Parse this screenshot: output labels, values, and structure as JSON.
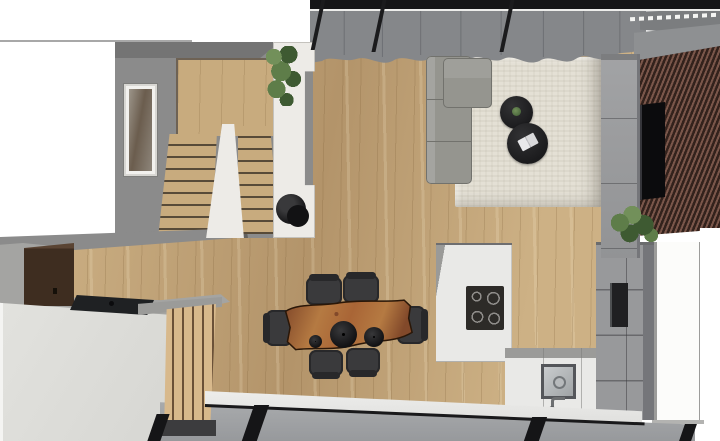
{
  "scene": {
    "view": "top-down 3D architectural render of an open-plan ground floor",
    "areas": {
      "stair_hall": [
        "u-shaped-staircase",
        "wall-art",
        "white-partition-wall",
        "hanging-plant",
        "black-round-stool"
      ],
      "living": [
        "corner-sofa",
        "area-rug",
        "two-round-coffee-tables",
        "small-plant-decor",
        "open-book",
        "tv-screen",
        "slat-accent-wall",
        "tv-cabinet-column",
        "potted-plant",
        "curtain-glazed-wall"
      ],
      "dining": [
        "live-edge-wood-table",
        "six-black-chairs",
        "three-round-pendants"
      ],
      "kitchen": [
        "island-with-induction-cooktop",
        "sink-counter-with-faucet",
        "tall-appliance-wall-with-oven",
        "white-door"
      ],
      "desk_nook": [
        "dark-brown-wall-cabinet",
        "gray-desk-top",
        "laptop",
        "white-counter-block",
        "wood-slat-screen"
      ],
      "facade": [
        "glazed-sliding-wall-bottom",
        "glazed-roof-edge-top",
        "gray-beam"
      ]
    }
  },
  "palette": {
    "background": "#ffffff",
    "wall_gray": "#8b8b8b",
    "wall_gray_dark": "#747474",
    "floor_wood": "#cdb185",
    "floor_wood_streak": "#b3946a",
    "stair_wood": "#c8ab7e",
    "stair_nosing": "#574a38",
    "white_wall": "#edebe7",
    "rug": "#e4e0d5",
    "sofa": "#95958f",
    "sofa_dark": "#72726d",
    "coffee_table_black": "#1b1b1d",
    "chair_black": "#3a3a3c",
    "chair_black_dark": "#28282a",
    "dining_wood": "#a96536",
    "dining_wood_light": "#b57a42",
    "dining_wood_dark": "#82492a",
    "dining_edge": "#2a1708",
    "slat_brown": "#7a564a",
    "slat_brown_dark": "#33221c",
    "tv_black": "#0b0b0d",
    "cabinet_gray": "#98999b",
    "cabinet_gray_dark": "#75767a",
    "island_white": "#e9e9e7",
    "island_side": "#9a9a98",
    "cooktop_black": "#2d2b28",
    "cooktop_ring": "#8f8d8a",
    "oven_black": "#202022",
    "sink_dark": "#54565a",
    "sink_steel": "#c9ccce",
    "curtain": "#85878a",
    "curtain_fold": "#6e7074",
    "frame_black": "#151517",
    "glass_pane": "#aaacae",
    "glass_pane_dark": "#97999c",
    "threshold_white": "#efefed",
    "counter_white": "#d6d6d2",
    "desk_gray": "#a4a4a2",
    "cabinet_brown": "#3e2d20",
    "cabinet_brown_light": "#5a4433",
    "laptop_black": "#1f2123",
    "plant_green": "#5e7d49",
    "plant_green_light": "#72905a",
    "plant_green_dark": "#3e5a32",
    "wood_slat_light": "#d8b98c",
    "wood_slat_gap": "#6b5138",
    "beam_gray": "#8e9092",
    "line_gray": "#a8a8a8"
  }
}
